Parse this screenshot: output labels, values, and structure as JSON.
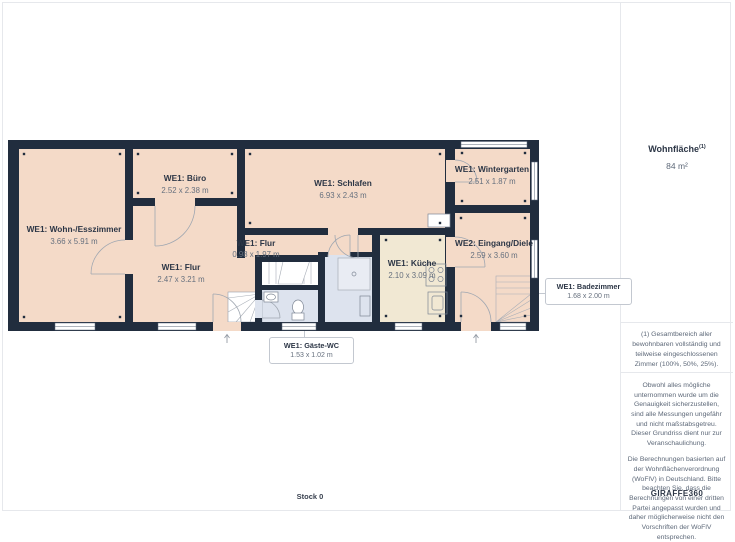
{
  "floor_label": "Stock 0",
  "sidebar": {
    "area_title": "Wohnfläche",
    "area_sup": "(1)",
    "area_value": "84 m²",
    "footnote": "(1) Gesamtbereich aller bewohnbaren vollständig und teilweise eingeschlossenen Zimmer (100%, 50%, 25%).",
    "disclaimer_p1": "Obwohl alles mögliche unternommen wurde um die Genauigkeit sicherzustellen, sind alle Messungen ungefähr und nicht maßstabsgetreu. Dieser Grundriss dient nur zur Veranschaulichung.",
    "disclaimer_p2": "Die Berechnungen basierten auf der Wohnflächenverordnung (WoFlV) in Deutschland. Bitte beachten Sie, dass die Berechnungen von einer dritten Partei angepasst wurden und daher möglicherweise nicht den Vorschriften der WoFlV entsprechen.",
    "brand_name": "GIRAFFE",
    "brand_suffix": "360"
  },
  "rooms": [
    {
      "name": "WE1: Wohn-/Esszimmer",
      "dims": "3.66 x 5.91 m"
    },
    {
      "name": "WE1: Büro",
      "dims": "2.52 x 2.38 m"
    },
    {
      "name": "WE1: Schlafen",
      "dims": "6.93 x 2.43 m"
    },
    {
      "name": "WE1: Wintergarten",
      "dims": "2.51 x 1.87 m"
    },
    {
      "name": "WE1: Flur",
      "dims": "0.98 x 1.97 m"
    },
    {
      "name": "WE1: Flur",
      "dims": "2.47 x 3.21 m"
    },
    {
      "name": "WE2: Eingang/Diele",
      "dims": "2.59 x 3.60 m"
    },
    {
      "name": "WE1: Küche",
      "dims": "2.10 x 3.09 m"
    },
    {
      "name": "WE1: Badezimmer",
      "dims": "1.68 x 2.00 m"
    },
    {
      "name": "WE1: Gäste-WC",
      "dims": "1.53 x 1.02 m"
    }
  ],
  "colors": {
    "wall": "#212d3e",
    "room_fill": "#f4dac8",
    "kitchen_fill": "#f1e8d3",
    "bath_fill": "#dde3ee",
    "label_text": "#2c3646",
    "dim_text": "#66707e"
  }
}
